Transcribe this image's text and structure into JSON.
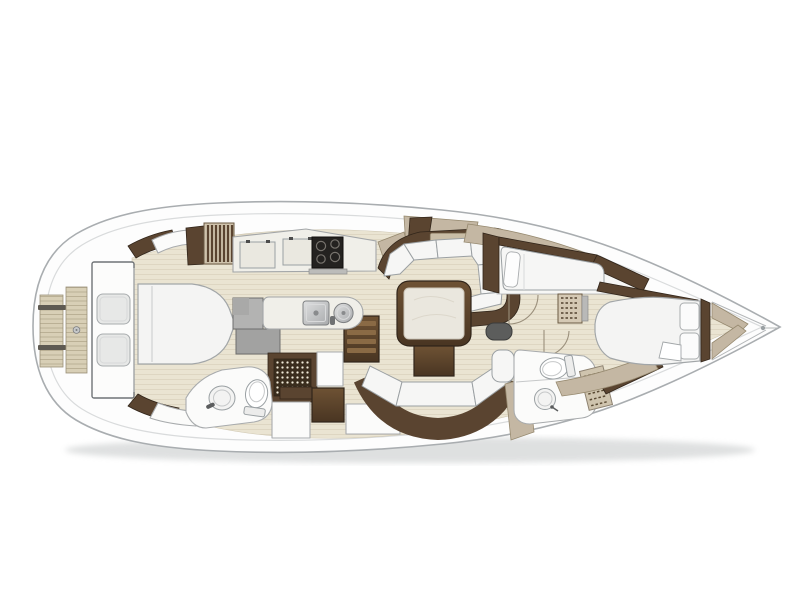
{
  "page": {
    "title": "Sailing yacht interior layout - top-down floor plan",
    "background": "#ffffff",
    "width": 800,
    "height": 600
  },
  "colors": {
    "hullFill": "#fdfdfd",
    "hullStroke": "#a9adb0",
    "deckLine": "#d9dbdc",
    "shadow": "#aeb2b3",
    "floor": "#eae4d2",
    "floorLine": "#ddd5c0",
    "teak": "#d8cfb6",
    "teakLine": "#b3a98d",
    "walnut": "#5a4430",
    "walnutLight": "#8a6a45",
    "walnutDark": "#31251a",
    "tan": "#c4b7a3",
    "tanStroke": "#96896f",
    "cushion": "#f6f6f5",
    "cushionStroke": "#9ba0a3",
    "furnWhite": "#fbfbfa",
    "furnStroke": "#a8abad",
    "greyCushion": "#e7e8e7",
    "greyDesk": "#b3b3b2",
    "greyDeskDark": "#a2a2a1",
    "cooktopBlack": "#242220",
    "steelLight": "#dfe0e1",
    "steelDark": "#a8aaac",
    "grate": "#3a2d1d",
    "grateDot": "#efe8d6",
    "doorArc": "#9a8f7b",
    "pouf": "#5c5d5c",
    "marble": "#eae7de"
  },
  "regions": [
    {
      "id": "swim-platform",
      "name": "swim platform with teak steps"
    },
    {
      "id": "cockpit",
      "name": "cockpit with twin bench cushions"
    },
    {
      "id": "aft-cabin",
      "name": "aft cabin with double berth"
    },
    {
      "id": "nav-station",
      "name": "nav station desk"
    },
    {
      "id": "shower",
      "name": "shower with teak grate"
    },
    {
      "id": "aft-head",
      "name": "aft head with sink and toilet"
    },
    {
      "id": "galley",
      "name": "galley with cooktop and twin sinks"
    },
    {
      "id": "companionway",
      "name": "companionway steps"
    },
    {
      "id": "salon",
      "name": "salon with U-settee and dining table"
    },
    {
      "id": "starboard-settee",
      "name": "curved starboard settee"
    },
    {
      "id": "guest-cabin",
      "name": "guest cabin with single berth"
    },
    {
      "id": "forward-head",
      "name": "forward head with sink and toilet"
    },
    {
      "id": "forward-cabin",
      "name": "forward cabin with island double berth"
    },
    {
      "id": "bow",
      "name": "bow with anchor fitting"
    }
  ]
}
